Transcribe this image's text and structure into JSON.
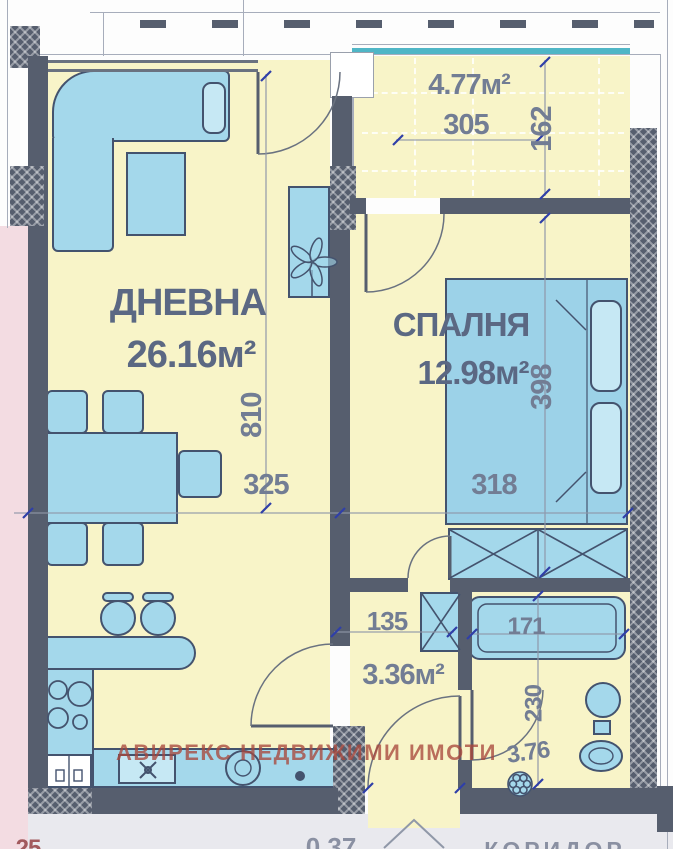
{
  "watermark": "АВИРЕКС НЕДВИЖИМИ ИМОТИ",
  "rooms": {
    "living": {
      "name": "ДНЕВНА",
      "area": "26.16м²"
    },
    "bedroom": {
      "name": "СПАЛНЯ",
      "area": "12.98м²"
    },
    "terrace": {
      "area": "4.77м²"
    },
    "hallway": {
      "area": "3.36м²"
    },
    "bathroom": {
      "area": "3.76"
    }
  },
  "dimensions": {
    "terrace_width": "305",
    "terrace_depth": "162",
    "living_length": "810",
    "living_width": "325",
    "bedroom_width": "318",
    "bedroom_length": "398",
    "hallway_width": "135",
    "bath_width": "171",
    "bath_length": "230"
  },
  "edge_labels": {
    "bottom_left": "25",
    "bottom_mid": "0.37",
    "bottom_right": "КОРИДОР"
  },
  "colors": {
    "wall": "#565e6e",
    "room_fill": "#f8f4c8",
    "furniture_fill": "#a4d8eb",
    "furniture_outline": "#44536e",
    "adjacent_pink": "#f3dce2",
    "railing_teal": "#4fb6c6",
    "dimension_text": "#727d94",
    "room_label_text": "#5b6883",
    "watermark_red": "#b0544c"
  }
}
